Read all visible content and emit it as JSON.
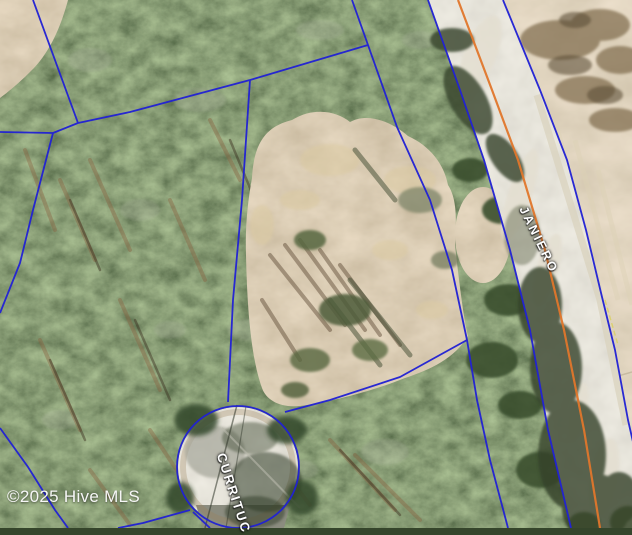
{
  "map": {
    "attribution": "©2025 Hive MLS",
    "road_labels": {
      "janiero": "JANIERO",
      "currituck": "CURRITUC"
    }
  },
  "colors": {
    "parcel_line": "#2222d4",
    "road_centerline": "#e0762b",
    "edge_marking": "#d8d05e"
  }
}
